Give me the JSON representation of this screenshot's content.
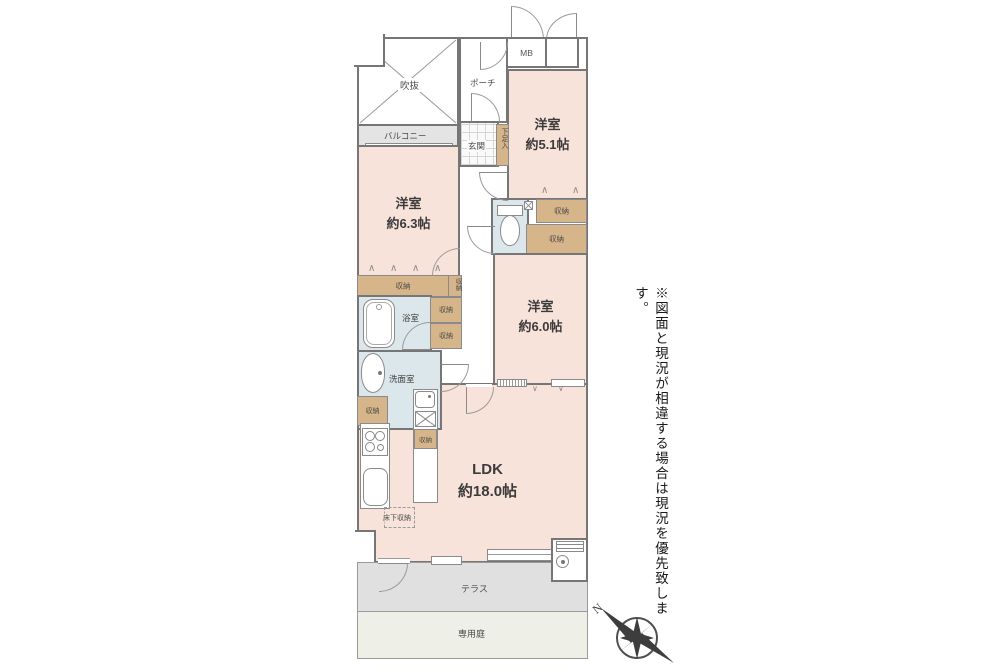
{
  "note": "※図面と現況が相違する場合は現況を優先致します。",
  "compass": {
    "north_label": "N"
  },
  "labels": {
    "atrium": "吹抜",
    "porch": "ポーチ",
    "meter_box": "MB",
    "balcony": "バルコニー",
    "entrance": "玄関",
    "shoe_box": "下足入",
    "bedroom51_name": "洋室",
    "bedroom51_size": "約5.1帖",
    "bedroom63_name": "洋室",
    "bedroom63_size": "約6.3帖",
    "bedroom60_name": "洋室",
    "bedroom60_size": "約6.0帖",
    "ldk_name": "LDK",
    "ldk_size": "約18.0帖",
    "bathroom": "浴室",
    "washroom": "洗面室",
    "storage": "収納",
    "underfloor_storage": "床下収納",
    "terrace": "テラス",
    "private_garden": "専用庭"
  },
  "colors": {
    "room_pink": "#f8e3da",
    "storage_tan": "#d7b58a",
    "wet_area_blue": "#dce7eb",
    "balcony_gray": "#e4e4e4",
    "terrace_gray": "#e0e0e0",
    "garden_green": "#eef0e7",
    "wall_gray": "#767676"
  }
}
